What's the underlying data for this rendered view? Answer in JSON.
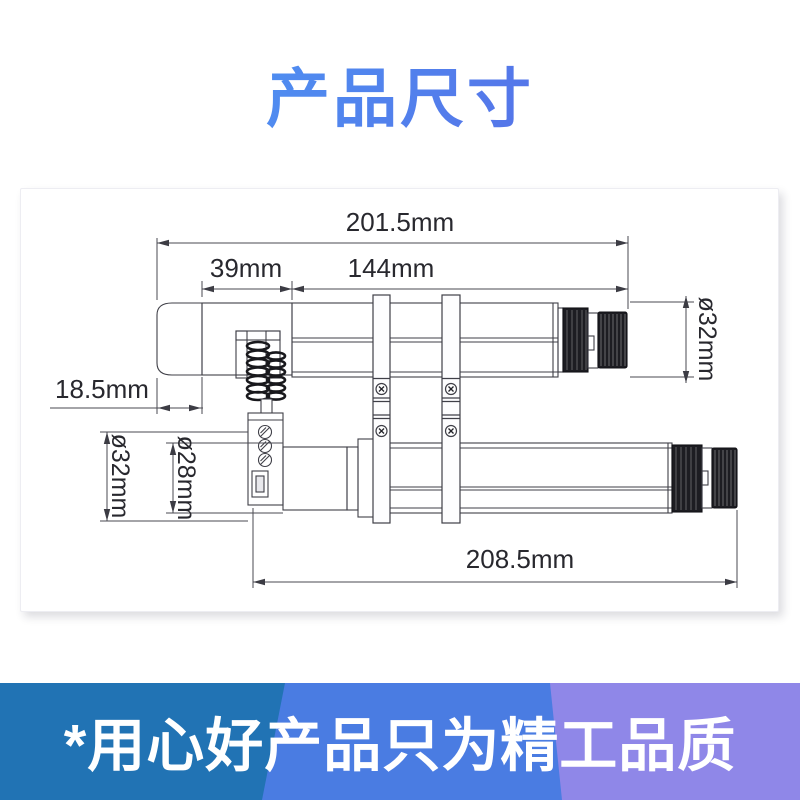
{
  "title": {
    "text": "产品尺寸"
  },
  "footer": {
    "text": "*用心好产品只为精工品质"
  },
  "diagram": {
    "labels": {
      "total_length_top": "201.5mm",
      "segment_39": "39mm",
      "segment_144": "144mm",
      "cap_length": "18.5mm",
      "diameter_right": "ø32mm",
      "diameter_left_outer": "ø32mm",
      "diameter_left_inner": "ø28mm",
      "total_length_bottom": "208.5mm"
    }
  },
  "colors": {
    "title_gradient_start": "#4aa1f7",
    "title_gradient_end": "#5a61e2",
    "banner_band_left": "#2173b4",
    "banner_band_middle": "#4a7ce2",
    "banner_band_right": "#8f87e8",
    "banner_text": "#ffffff",
    "drawing_line": "#3f3f47",
    "dimension_text": "#28282e"
  }
}
